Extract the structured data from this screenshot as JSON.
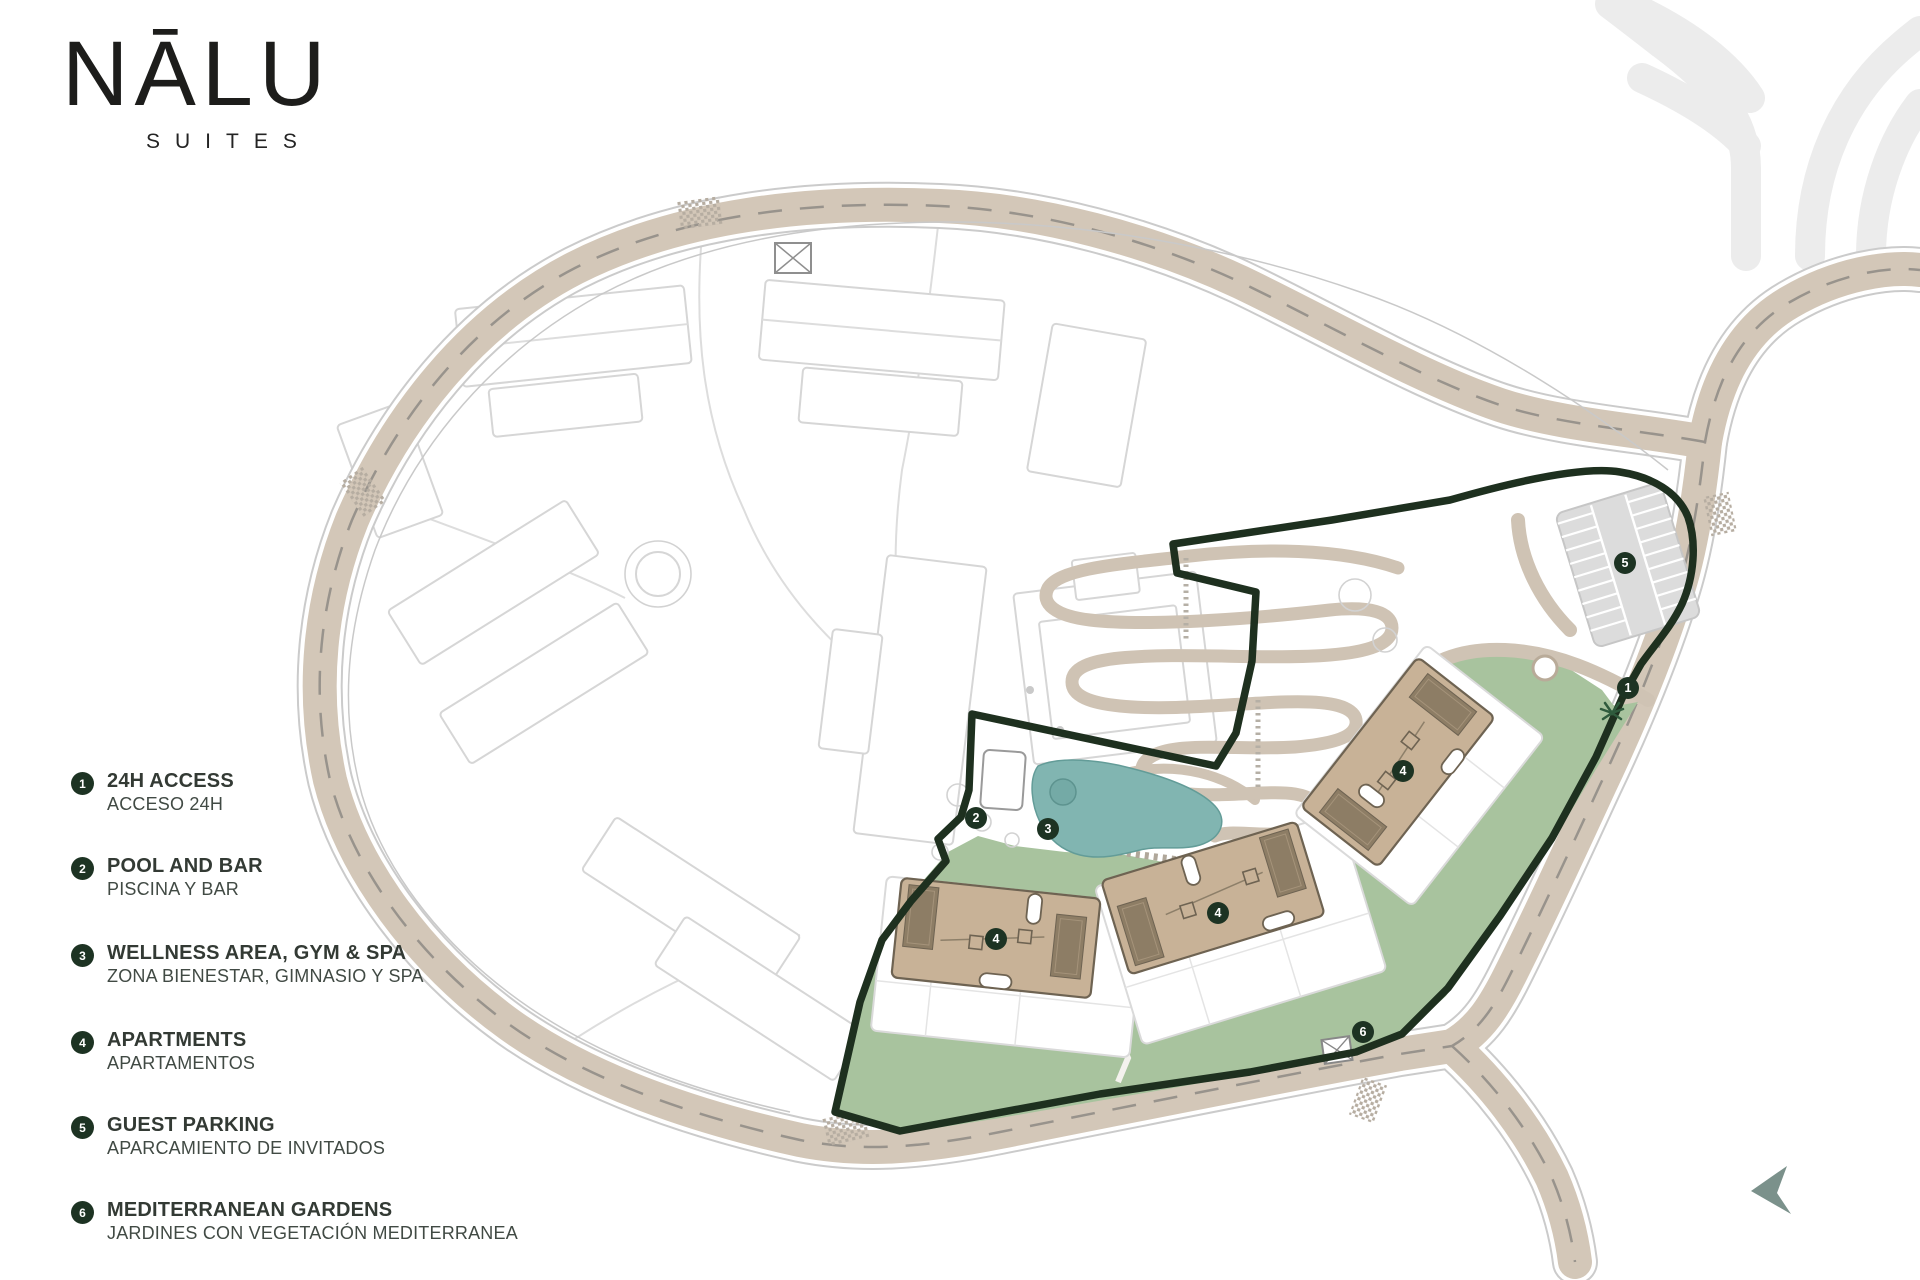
{
  "brand": {
    "name": "NĀLU",
    "tagline": "SUITES"
  },
  "legend": {
    "items": [
      {
        "number": "1",
        "title": "24H ACCESS",
        "subtitle": "ACCESO 24H"
      },
      {
        "number": "2",
        "title": "POOL AND BAR",
        "subtitle": "PISCINA Y BAR"
      },
      {
        "number": "3",
        "title": "WELLNESS AREA, GYM & SPA",
        "subtitle": "ZONA BIENESTAR, GIMNASIO Y SPA"
      },
      {
        "number": "4",
        "title": "APARTMENTS",
        "subtitle": "APARTAMENTOS"
      },
      {
        "number": "5",
        "title": "GUEST PARKING",
        "subtitle": "APARCAMIENTO DE INVITADOS"
      },
      {
        "number": "6",
        "title": "MEDITERRANEAN GARDENS",
        "subtitle": "JARDINES CON VEGETACIÓN MEDITERRANEA"
      }
    ]
  },
  "map": {
    "markers": [
      {
        "label": "1",
        "x": 1628,
        "y": 688
      },
      {
        "label": "2",
        "x": 976,
        "y": 818
      },
      {
        "label": "3",
        "x": 1048,
        "y": 829
      },
      {
        "label": "4",
        "x": 996,
        "y": 939
      },
      {
        "label": "4",
        "x": 1218,
        "y": 913
      },
      {
        "label": "4",
        "x": 1403,
        "y": 771
      },
      {
        "label": "5",
        "x": 1625,
        "y": 563
      },
      {
        "label": "6",
        "x": 1363,
        "y": 1032
      }
    ]
  },
  "colors": {
    "badge": "#1d3323",
    "boundary": "#1e301f",
    "road": "#d3c7b8",
    "garden": "#a8c39e",
    "pool": "#81b5b1",
    "building": "#c8b297",
    "compass": "#7b918b",
    "motif": "#ececec"
  }
}
